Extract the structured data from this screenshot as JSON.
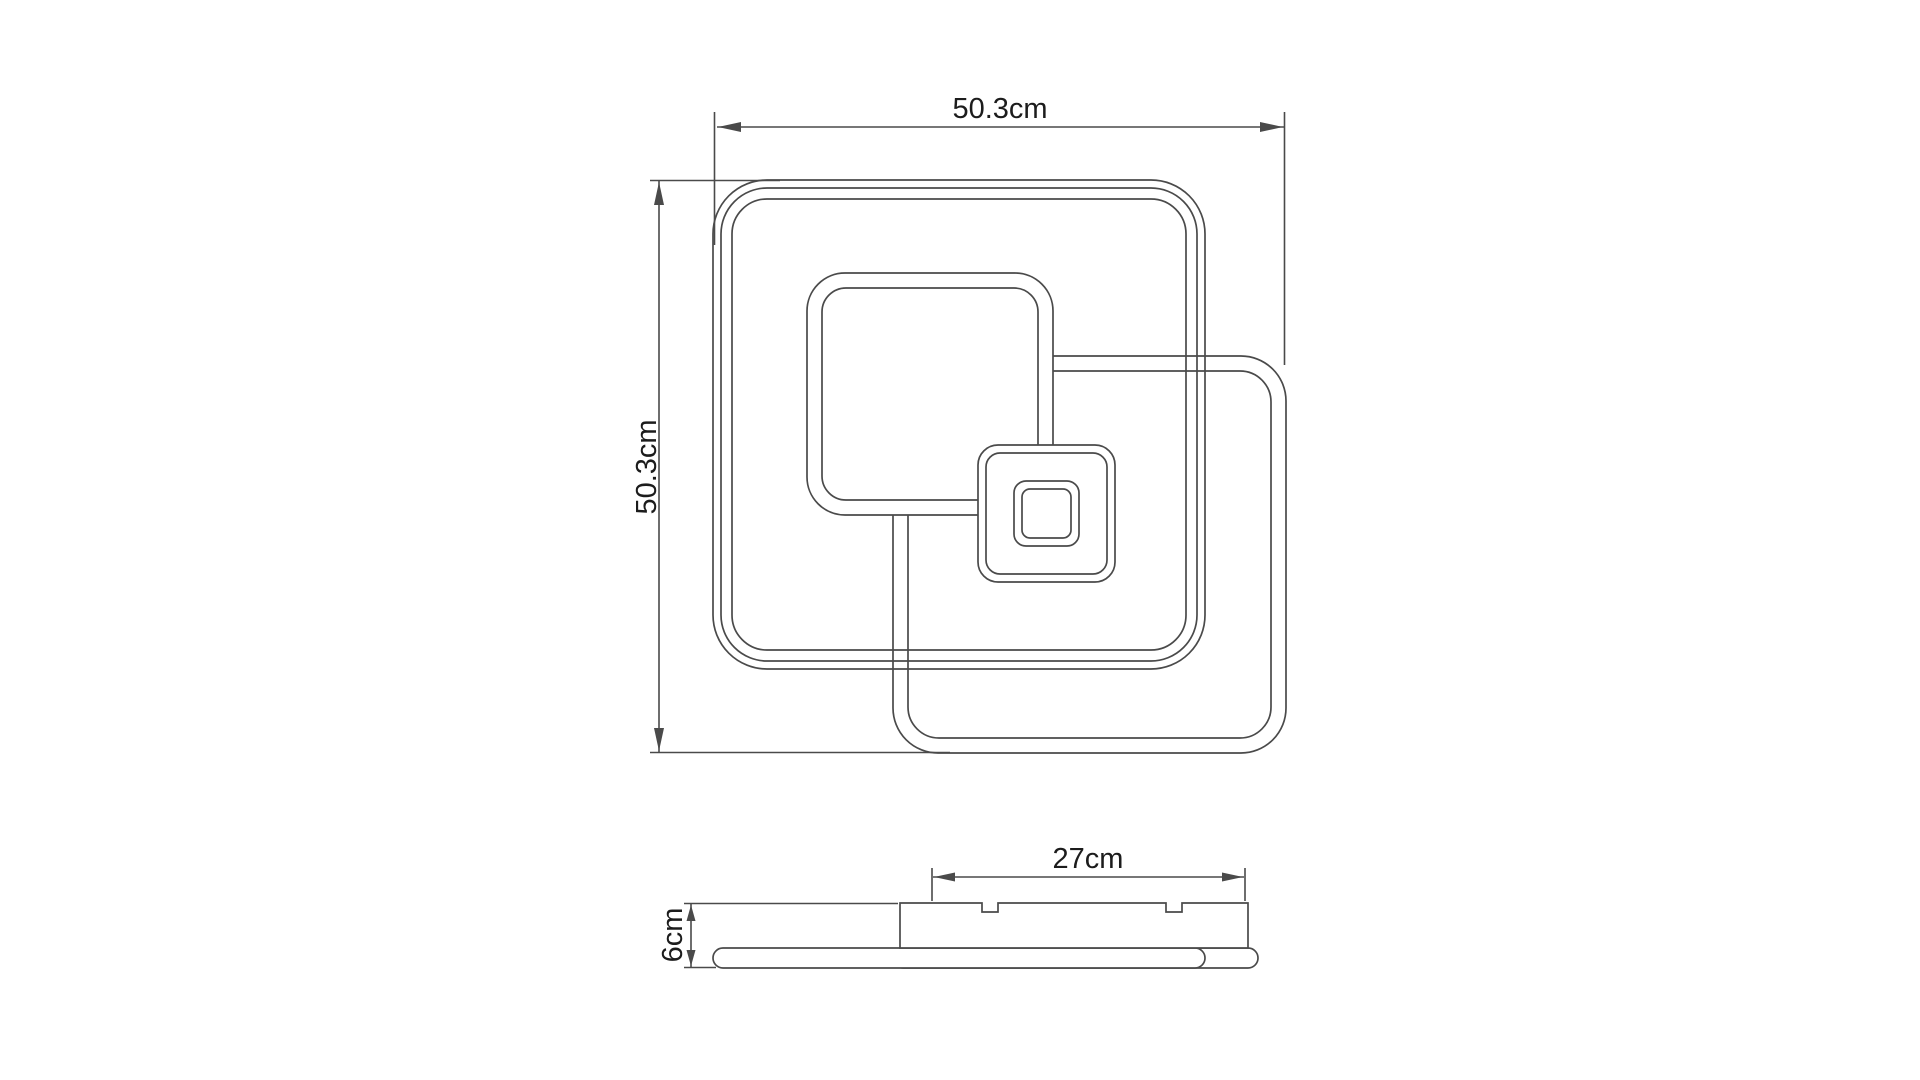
{
  "document": {
    "type": "technical-dimension-drawing",
    "subject": "square LED ceiling light with three overlapping square rings",
    "views": [
      "top-view",
      "side-view"
    ]
  },
  "dimensions": {
    "overall_width": {
      "label": "50.3cm",
      "value_cm": 50.3,
      "applies_to": "overall width, top view"
    },
    "overall_height": {
      "label": "50.3cm",
      "value_cm": 50.3,
      "applies_to": "overall depth, top view"
    },
    "mount_plate_width": {
      "label": "27cm",
      "value_cm": 27,
      "applies_to": "canopy / mounting plate width, side view"
    },
    "fixture_height": {
      "label": "6cm",
      "value_cm": 6,
      "applies_to": "overall height, side view"
    }
  },
  "labels": {
    "top_width": "50.3cm",
    "left_height": "50.3cm",
    "plate_width": "27cm",
    "side_height": "6cm"
  },
  "colors": {
    "line": "#4a4a4a",
    "text": "#1c1c1c",
    "background": "#ffffff"
  }
}
